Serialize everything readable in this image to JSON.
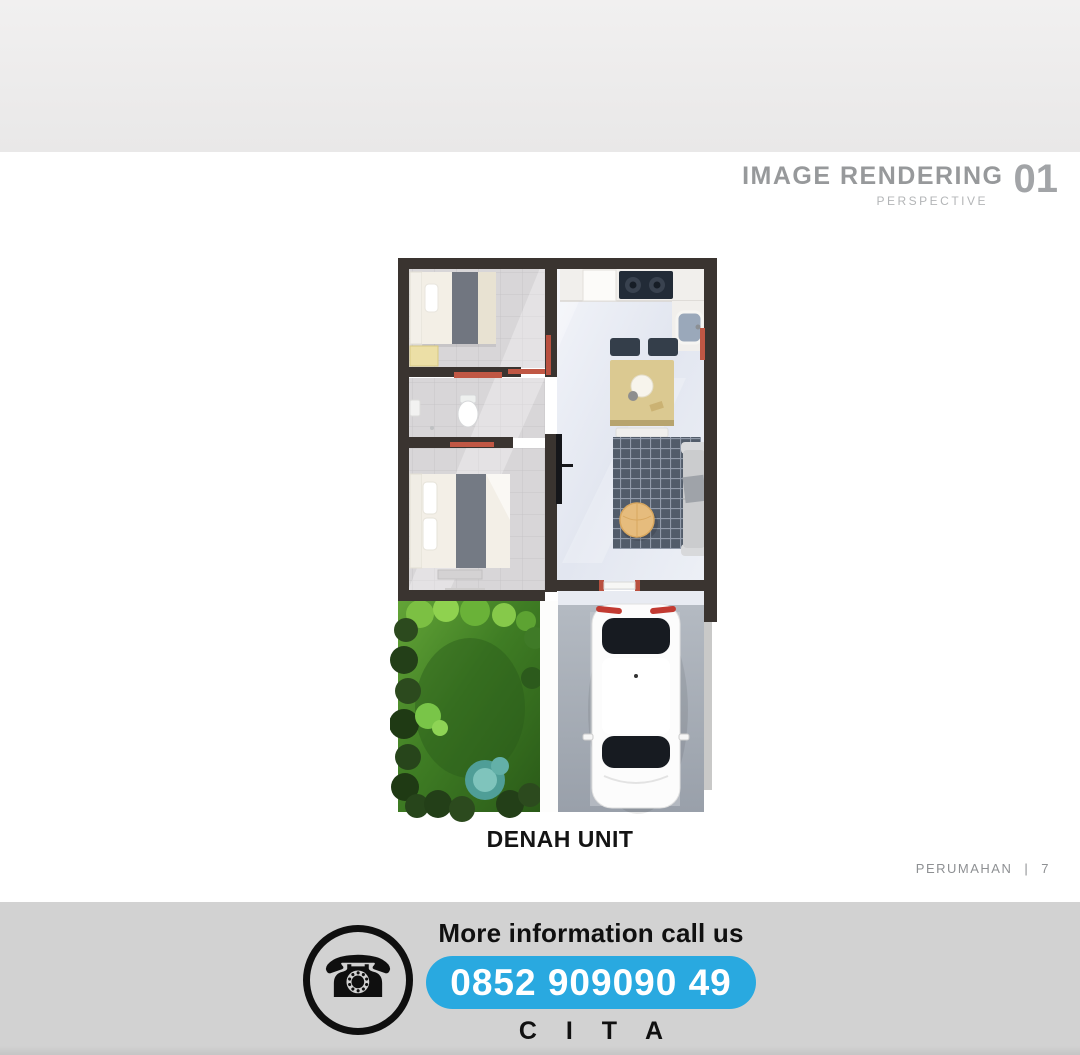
{
  "header": {
    "title": "IMAGE RENDERING",
    "number": "01",
    "subtitle": "PERSPECTIVE"
  },
  "plan": {
    "caption": "DENAH UNIT"
  },
  "page_meta": {
    "label": "PERUMAHAN",
    "separator": "|",
    "page_number": "7"
  },
  "contact": {
    "heading": "More information call us",
    "phone": "0852 909090 49",
    "brand": "C I T A",
    "phone_icon_glyph": "☎"
  },
  "palette": {
    "accent_blue": "#29a9e0",
    "footer_bg": "#d2d2d2",
    "band_gray_top": "#f1f0f0",
    "band_gray_bottom": "#e9e8e8",
    "header_gray": "#97999b",
    "wall_dark": "#3a3430",
    "text_dark": "#141414"
  }
}
